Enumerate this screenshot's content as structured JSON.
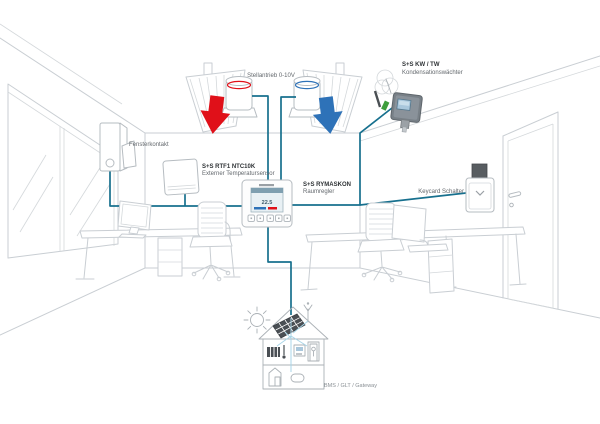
{
  "colors": {
    "wire": "#17708E",
    "wire_light": "#A9D6E8",
    "hot": "#E01019",
    "cold": "#2E72B8",
    "outline": "#C9CED3"
  },
  "devices": {
    "actuators": {
      "label": "Stellantrieb 0-10V"
    },
    "condensation_monitor": {
      "name": "S+S KW / TW",
      "type": "Kondensationswächter"
    },
    "window_contact": {
      "label": "Fensterkontakt"
    },
    "external_temp_sensor": {
      "name": "S+S RTF1 NTC10K",
      "type": "Externer Temperatursensor"
    },
    "room_controller": {
      "name": "S+S RYMASKON",
      "type": "Raumregler",
      "display_value": "22.5"
    },
    "keycard_switch": {
      "label": "Keycard Schalter"
    },
    "bms_gateway": {
      "label": "BMS / GLT / Gateway"
    }
  }
}
